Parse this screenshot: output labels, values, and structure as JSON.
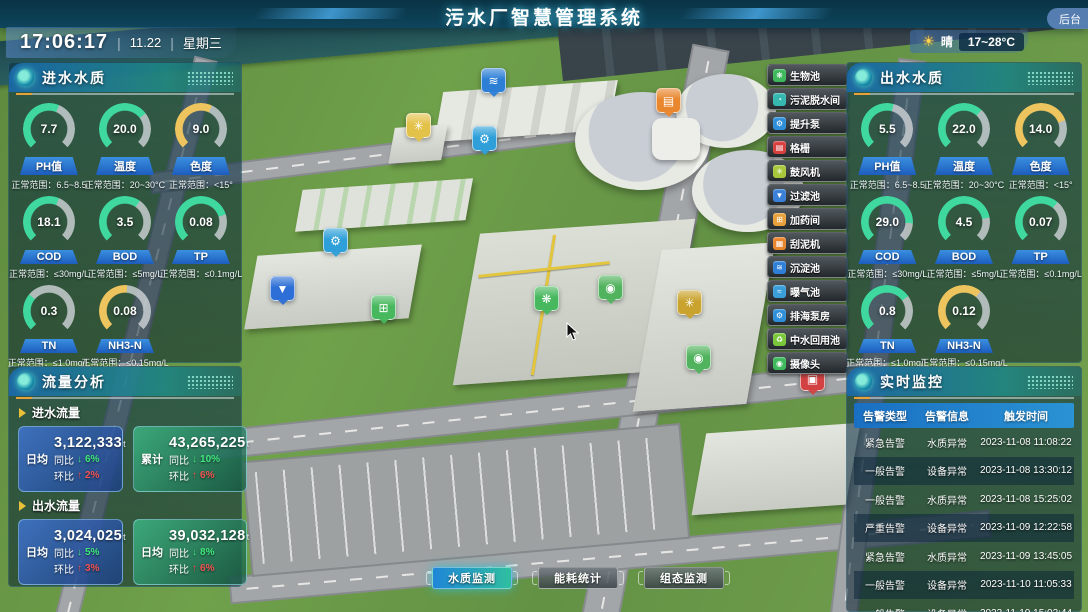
{
  "header": {
    "title": "污水厂智慧管理系统",
    "time": "17:06:17",
    "date": "11.22",
    "weekday": "星期三",
    "separator": "|",
    "weather": {
      "condition": "晴",
      "temp_range": "17~28°C",
      "icon": "sun-icon"
    },
    "backstage_label": "后台"
  },
  "inlet_quality": {
    "title": "进水水质",
    "gauges": [
      {
        "value": "7.7",
        "label": "PH值",
        "range": "正常范围：6.5~8.5",
        "color": "#3fd9a0",
        "deg": 158
      },
      {
        "value": "20.0",
        "label": "温度",
        "range": "正常范围：20~30°C",
        "color": "#3fd9a0",
        "deg": 188
      },
      {
        "value": "9.0",
        "label": "色度",
        "range": "正常范围：<15°",
        "color": "#eec45e",
        "deg": 160
      },
      {
        "value": "18.1",
        "label": "COD",
        "range": "正常范围：≤30mg/L",
        "color": "#3fd9a0",
        "deg": 158
      },
      {
        "value": "3.5",
        "label": "BOD",
        "range": "正常范围：≤5mg/L",
        "color": "#3fd9a0",
        "deg": 170
      },
      {
        "value": "0.08",
        "label": "TP",
        "range": "正常范围：≤0.1mg/L",
        "color": "#3fd9a0",
        "deg": 208
      },
      {
        "value": "0.3",
        "label": "TN",
        "range": "正常范围：≤1.0mg/L",
        "color": "#3fd9a0",
        "deg": 85
      },
      {
        "value": "0.08",
        "label": "NH3-N",
        "range": "正常范围：≤0.15mg/L",
        "color": "#eec45e",
        "deg": 140
      }
    ]
  },
  "outlet_quality": {
    "title": "出水水质",
    "gauges": [
      {
        "value": "5.5",
        "label": "PH值",
        "range": "正常范围：6.5~8.5",
        "color": "#3fd9a0",
        "deg": 150
      },
      {
        "value": "22.0",
        "label": "温度",
        "range": "正常范围：20~30°C",
        "color": "#3fd9a0",
        "deg": 178
      },
      {
        "value": "14.0",
        "label": "色度",
        "range": "正常范围：<15°",
        "color": "#eec45e",
        "deg": 205
      },
      {
        "value": "29.0",
        "label": "COD",
        "range": "正常范围：≤30mg/L",
        "color": "#3fd9a0",
        "deg": 228
      },
      {
        "value": "4.5",
        "label": "BOD",
        "range": "正常范围：≤5mg/L",
        "color": "#3fd9a0",
        "deg": 215
      },
      {
        "value": "0.07",
        "label": "TP",
        "range": "正常范围：≤0.1mg/L",
        "color": "#3fd9a0",
        "deg": 175
      },
      {
        "value": "0.8",
        "label": "TN",
        "range": "正常范围：≤1.0mg/L",
        "color": "#3fd9a0",
        "deg": 190
      },
      {
        "value": "0.12",
        "label": "NH3-N",
        "range": "正常范围：≤0.15mg/L",
        "color": "#eec45e",
        "deg": 175
      }
    ]
  },
  "flow_analysis": {
    "title": "流量分析",
    "sections": [
      {
        "name": "进水流量",
        "cards": [
          {
            "tag": "日均",
            "value": "3,122,333",
            "unit": "t",
            "yoy_label": "同比",
            "yoy": "6%",
            "mom_label": "环比",
            "mom": "2%"
          },
          {
            "tag": "累计",
            "value": "43,265,225",
            "unit": "t",
            "yoy_label": "同比",
            "yoy": "10%",
            "mom_label": "环比",
            "mom": "6%"
          }
        ]
      },
      {
        "name": "出水流量",
        "cards": [
          {
            "tag": "日均",
            "value": "3,024,025",
            "unit": "t",
            "yoy_label": "同比",
            "yoy": "5%",
            "mom_label": "环比",
            "mom": "3%"
          },
          {
            "tag": "日均",
            "value": "39,032,128",
            "unit": "t",
            "yoy_label": "同比",
            "yoy": "8%",
            "mom_label": "环比",
            "mom": "6%"
          }
        ]
      }
    ]
  },
  "monitoring": {
    "title": "实时监控",
    "columns": [
      "告警类型",
      "告警信息",
      "触发时间"
    ],
    "rows": [
      [
        "紧急告警",
        "水质异常",
        "2023-11-08 11:08:22"
      ],
      [
        "一般告警",
        "设备异常",
        "2023-11-08 13:30:12"
      ],
      [
        "一般告警",
        "水质异常",
        "2023-11-08 15:25:02"
      ],
      [
        "严重告警",
        "设备异常",
        "2023-11-09 12:22:58"
      ],
      [
        "紧急告警",
        "水质异常",
        "2023-11-09 13:45:05"
      ],
      [
        "一般告警",
        "设备异常",
        "2023-11-10 11:05:33"
      ],
      [
        "一般告警",
        "设备异常",
        "2023-11-10 15:02:44"
      ]
    ]
  },
  "facility_menu": {
    "items": [
      {
        "label": "生物池",
        "color": "#3db85a",
        "glyph": "❋"
      },
      {
        "label": "污泥脱水间",
        "color": "#35b8b0",
        "glyph": "◔"
      },
      {
        "label": "提升泵",
        "color": "#2e8fd8",
        "glyph": "⚙"
      },
      {
        "label": "格栅",
        "color": "#d84040",
        "glyph": "▤"
      },
      {
        "label": "鼓风机",
        "color": "#a8c83a",
        "glyph": "✳"
      },
      {
        "label": "过滤池",
        "color": "#3a7fd8",
        "glyph": "▼"
      },
      {
        "label": "加药间",
        "color": "#e8a03a",
        "glyph": "⊞"
      },
      {
        "label": "刮泥机",
        "color": "#e8862e",
        "glyph": "▦"
      },
      {
        "label": "沉淀池",
        "color": "#2e7fd8",
        "glyph": "≋"
      },
      {
        "label": "曝气池",
        "color": "#3a9fd8",
        "glyph": "≈"
      },
      {
        "label": "排海泵房",
        "color": "#2e8fd8",
        "glyph": "⚙"
      },
      {
        "label": "中水回用池",
        "color": "#7ac83a",
        "glyph": "♻"
      },
      {
        "label": "摄像头",
        "color": "#3db85a",
        "glyph": "◉"
      }
    ]
  },
  "map_markers": [
    {
      "name": "sedimentation",
      "color": "#2d7fd6",
      "glyph": "≋"
    },
    {
      "name": "blower-1",
      "color": "#e3c24a",
      "glyph": "✳"
    },
    {
      "name": "lift-pump-1",
      "color": "#2e9fd8",
      "glyph": "⚙"
    },
    {
      "name": "bar-screen",
      "color": "#e8872e",
      "glyph": "▤"
    },
    {
      "name": "lift-pump-2",
      "color": "#2e9fd8",
      "glyph": "⚙"
    },
    {
      "name": "filter-pool",
      "color": "#2d6fd6",
      "glyph": "▼"
    },
    {
      "name": "dosing-room",
      "color": "#47b85e",
      "glyph": "⊞"
    },
    {
      "name": "bio-pool",
      "color": "#47b85e",
      "glyph": "❋"
    },
    {
      "name": "camera-1",
      "color": "#52b35e",
      "glyph": "◉"
    },
    {
      "name": "blower-2",
      "color": "#c9a32e",
      "glyph": "✳"
    },
    {
      "name": "camera-2",
      "color": "#52b35e",
      "glyph": "◉"
    },
    {
      "name": "alarm-device",
      "color": "#d24242",
      "glyph": "▣"
    }
  ],
  "bottom_tabs": [
    {
      "label": "水质监测",
      "active": true
    },
    {
      "label": "能耗统计",
      "active": false
    },
    {
      "label": "组态监测",
      "active": false
    }
  ]
}
